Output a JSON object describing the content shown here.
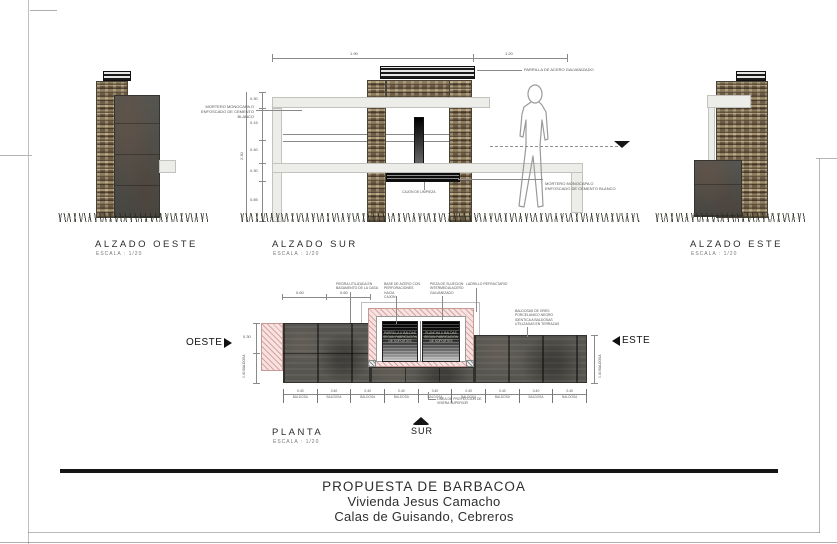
{
  "title_block": {
    "line1": "PROPUESTA DE BARBACOA",
    "line2": "Vivienda Jesus Camacho",
    "line3": "Calas de Guisando, Cebreros"
  },
  "views": {
    "oeste": {
      "title": "ALZADO OESTE",
      "scale": "ESCALA : 1/20"
    },
    "sur": {
      "title": "ALZADO SUR",
      "scale": "ESCALA : 1/20"
    },
    "este": {
      "title": "ALZADO ESTE",
      "scale": "ESCALA : 1/20"
    },
    "planta": {
      "title": "PLANTA",
      "scale": "ESCALA : 1/20"
    }
  },
  "compass": {
    "oeste": "OESTE",
    "este": "ESTE",
    "sur": "SUR"
  },
  "notes": {
    "parrilla": "PARRILLA DE ACERO GALVANIZADO",
    "mortero_izq": "MORTERO MONOCAPA O\nENFOSCADO DE CEMENTO BLANCO",
    "mortero_der": "MORTERO MONOCAPA O\nENFOSCADO DE CEMENTO BLANCO",
    "cajon": "CAJON DE LIMPIEZA",
    "piedra": "PIEDRA UTILIZADA EN\nBASAMENTO DE LA CASA",
    "base_acero": "BASE DE ACERO CON\nPERFORACIONES HACIA\nCAJON",
    "pieza": "PIEZA DE SUJECION\nINTERMEDIA ACERO\nGALVANIZADO",
    "ladrillo": "LADRILLO REFRACTARIO",
    "baldosas": "BALDOSAS DE GRES\nPORCELANICO NEGRO\nIDENTICA A BALDOSAS\nUTILIZADAS EN TERRAZAS",
    "linea_proyeccion": "LINEA DE PROYECCION DE\nVISERA SUPERIOR",
    "grill_parrilla": "PARRILLA U BALDAS\nSEGUN FABRICACION\nDE SOPORTES",
    "grill_plancha": "PLANCHA U BALDAS\nSEGUN FABRICACION\nDE SOPORTES"
  },
  "dims": {
    "sur_total": "2.30",
    "sur_v": [
      "0.30",
      "0.15",
      "0.40",
      "0.30",
      "0.85"
    ],
    "sur_top_left": "1.90",
    "sur_top_right": "1.20",
    "planta_top": [
      "0.60",
      "0.60"
    ],
    "tile": "0.40",
    "tile_unit": "BALDOSA",
    "left_small": "0.30",
    "left_rot": "0.40 BALDOSA",
    "right_rot": "0.40 BALDOSA"
  },
  "colors": {
    "stone_brown": "#8d7c5e",
    "concrete_gray": "#4f4e48",
    "hatch_pink": "#f6e3e1",
    "ink": "#2e2e2e"
  }
}
